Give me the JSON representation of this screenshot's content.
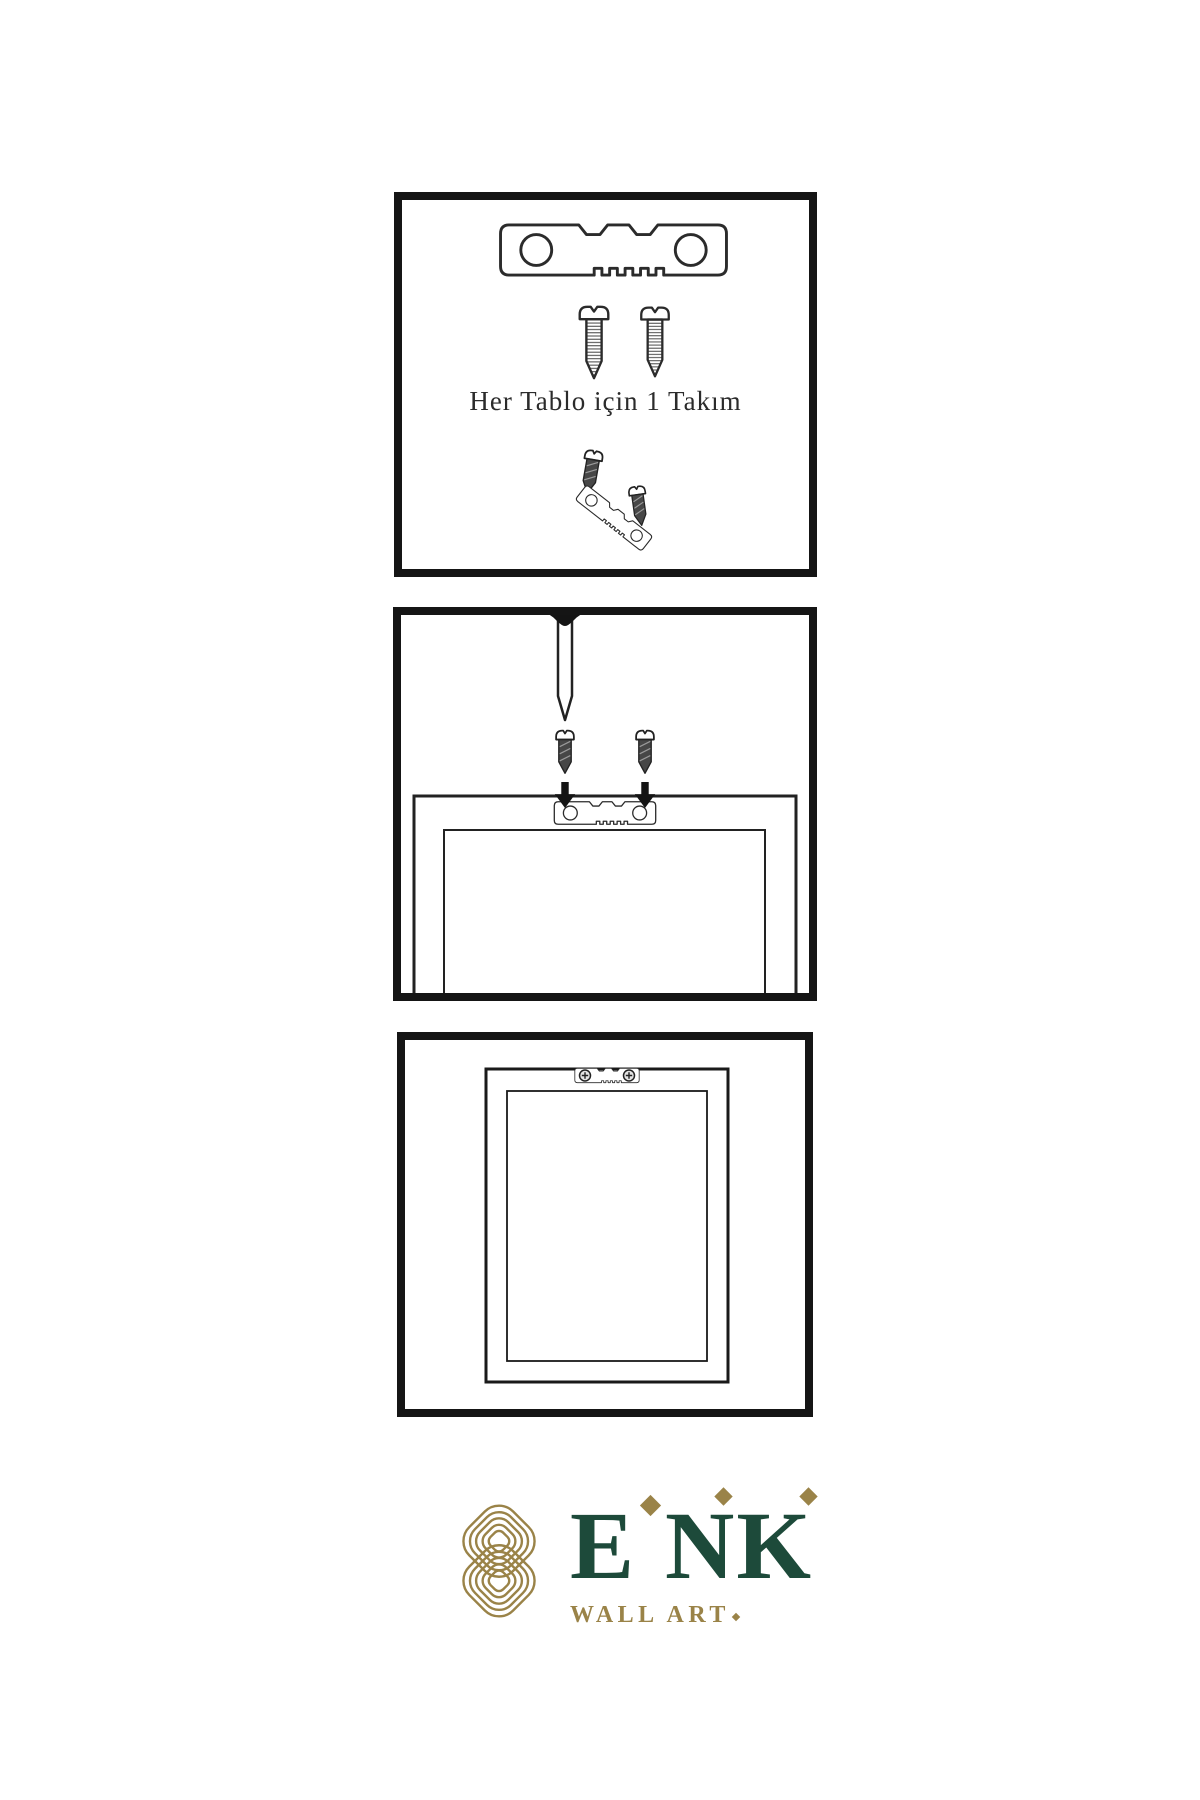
{
  "sheet": {
    "description": "wall-art hanging instruction sheet",
    "background": "#FFFFFF"
  },
  "panels": {
    "kit": {
      "caption": "Her Tablo için 1 Takım",
      "icons": [
        "sawtooth-hanger-icon",
        "screw-icon",
        "screw-icon",
        "screw-icon",
        "screw-icon",
        "tilted-sawtooth-hanger-icon"
      ]
    },
    "mounting": {
      "icons": [
        "nail-icon",
        "screw-icon",
        "screw-icon",
        "arrow-down-icon",
        "arrow-down-icon",
        "sawtooth-hanger-icon",
        "frame-back-view"
      ]
    },
    "finished": {
      "icons": [
        "frame-back-view",
        "sawtooth-hanger-icon",
        "phillips-screw-head-icon",
        "phillips-screw-head-icon"
      ]
    }
  },
  "logo": {
    "letters": [
      "E",
      "N",
      "K"
    ],
    "subtitle": "WALL ART",
    "mark": "interlocking-knot-icon",
    "colors": {
      "green": "#1D4A3A",
      "gold": "#9A8348"
    }
  },
  "colors": {
    "panel_border": "#151515",
    "line_art": "#2B2B2B",
    "screw_dark_fill": "#474747",
    "arrow": "#141414"
  }
}
